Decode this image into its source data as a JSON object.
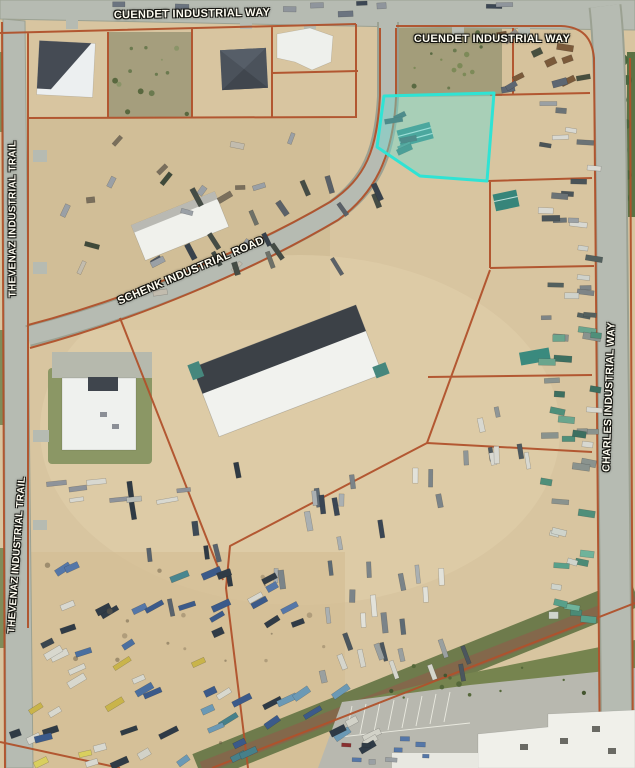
{
  "map": {
    "type": "aerial-parcel-map",
    "road_labels": [
      {
        "id": "cuendet-left",
        "text": "CUENDET INDUSTRIAL WAY"
      },
      {
        "id": "cuendet-right",
        "text": "CUENDET INDUSTRIAL WAY"
      },
      {
        "id": "thevenaz-upper",
        "text": "THEVENAZ INDUSTRIAL TRAIL"
      },
      {
        "id": "schenk",
        "text": "SCHENK INDUSTRIAL ROAD"
      },
      {
        "id": "thevenaz-lower",
        "text": "THEVENAZ INDUSTRIAL TRAIL"
      },
      {
        "id": "charles",
        "text": "CHARLES INDUSTRIAL WAY"
      }
    ],
    "highlight": {
      "label": "selected-parcel",
      "stroke": "#2fe3d4",
      "fill": "rgba(110,220,210,0.45)"
    },
    "colors": {
      "sand": "#d8c5a0",
      "road": "#b6bbb2",
      "parcel_line": "#b0512b",
      "scrub": "#a39d7a",
      "grass": "#76844f",
      "building_white": "#f0f1ec",
      "building_dark_roof": "#3e444c",
      "parking": "#b8b8af"
    },
    "features": {
      "clusters": [
        {
          "id": "top-road-vehicles",
          "x": 60,
          "y": 2,
          "w": 470,
          "h": 12,
          "n": 9,
          "ang": 0,
          "jit": 8,
          "len": 13,
          "wd": 5,
          "colors": [
            "#3c4754",
            "#6b7480",
            "#8f959c"
          ]
        },
        {
          "id": "topright-yard",
          "x": 500,
          "y": 32,
          "w": 85,
          "h": 58,
          "n": 13,
          "ang": -20,
          "jit": 60,
          "len": 13,
          "wd": 6,
          "colors": [
            "#5d6672",
            "#97918a",
            "#caa84b",
            "#7b5a3a",
            "#474f3f"
          ]
        },
        {
          "id": "topleft-yard",
          "x": 52,
          "y": 128,
          "w": 248,
          "h": 165,
          "n": 20,
          "ang": -25,
          "jit": 90,
          "len": 12,
          "wd": 5,
          "colors": [
            "#4e5661",
            "#9aa0a6",
            "#7a6f5c",
            "#3f4a3a",
            "#c2bcae"
          ]
        },
        {
          "id": "schenk-roadside",
          "x": 180,
          "y": 182,
          "w": 200,
          "h": 100,
          "n": 16,
          "ang": 65,
          "jit": 25,
          "len": 15,
          "wd": 5,
          "colors": [
            "#444c45",
            "#5a6168",
            "#38424c",
            "#6e7168"
          ]
        },
        {
          "id": "selected-parcel-trucks",
          "x": 388,
          "y": 112,
          "w": 48,
          "h": 42,
          "n": 5,
          "ang": -18,
          "jit": 20,
          "len": 14,
          "wd": 6,
          "colors": [
            "#2e6e66",
            "#45887e",
            "#334b50"
          ]
        },
        {
          "id": "right-strip-upper",
          "x": 543,
          "y": 100,
          "w": 52,
          "h": 125,
          "n": 15,
          "ang": 4,
          "jit": 14,
          "len": 14,
          "wd": 5,
          "colors": [
            "#d9d9d2",
            "#9aa0a4",
            "#6b7376",
            "#4a5458"
          ]
        },
        {
          "id": "right-strip-mid",
          "x": 545,
          "y": 235,
          "w": 50,
          "h": 85,
          "n": 10,
          "ang": 4,
          "jit": 14,
          "len": 14,
          "wd": 5,
          "colors": [
            "#cfd2cb",
            "#7e8587",
            "#53605e"
          ]
        },
        {
          "id": "right-strip-teal",
          "x": 546,
          "y": 325,
          "w": 52,
          "h": 195,
          "n": 24,
          "ang": 5,
          "jit": 16,
          "len": 14,
          "wd": 6,
          "colors": [
            "#4f8f7a",
            "#6aa58d",
            "#d8d8d0",
            "#3c6f60",
            "#8a938e"
          ]
        },
        {
          "id": "right-bottom-teal",
          "x": 550,
          "y": 528,
          "w": 50,
          "h": 92,
          "n": 12,
          "ang": 8,
          "jit": 18,
          "len": 13,
          "wd": 6,
          "colors": [
            "#58a08a",
            "#6fb39a",
            "#4b8a76",
            "#cfd4cc"
          ]
        },
        {
          "id": "center-rows",
          "x": 255,
          "y": 475,
          "w": 190,
          "h": 160,
          "n": 26,
          "ang": 85,
          "jit": 14,
          "len": 17,
          "wd": 5,
          "colors": [
            "#e2e2da",
            "#aab0b2",
            "#5d6a74",
            "#3a4654",
            "#7b8489"
          ]
        },
        {
          "id": "center-row-left",
          "x": 130,
          "y": 470,
          "w": 110,
          "h": 150,
          "n": 9,
          "ang": 80,
          "jit": 10,
          "len": 16,
          "wd": 5,
          "colors": [
            "#3e4a56",
            "#59636d",
            "#2f3a44"
          ]
        },
        {
          "id": "left-long-row",
          "x": 45,
          "y": 478,
          "w": 145,
          "h": 26,
          "n": 8,
          "ang": -8,
          "jit": 6,
          "len": 17,
          "wd": 5,
          "colors": [
            "#b9bcb6",
            "#8e939a",
            "#d8d8d0"
          ]
        },
        {
          "id": "bottomleft-row1",
          "x": 45,
          "y": 565,
          "w": 255,
          "h": 68,
          "n": 22,
          "ang": -25,
          "jit": 16,
          "len": 16,
          "wd": 6,
          "colors": [
            "#3b5a8a",
            "#5577a8",
            "#d8d8d0",
            "#49868f",
            "#303b46"
          ]
        },
        {
          "id": "bottomleft-row2",
          "x": 35,
          "y": 640,
          "w": 195,
          "h": 75,
          "n": 15,
          "ang": -25,
          "jit": 16,
          "len": 15,
          "wd": 6,
          "colors": [
            "#d8d8ce",
            "#c9b44a",
            "#4a6fa0",
            "#3a464f"
          ]
        },
        {
          "id": "bottomleft-row3",
          "x": 125,
          "y": 688,
          "w": 255,
          "h": 75,
          "n": 24,
          "ang": -30,
          "jit": 14,
          "len": 16,
          "wd": 6,
          "colors": [
            "#3b5a8a",
            "#46808a",
            "#d2d2c8",
            "#2e3a46",
            "#6b99b5"
          ]
        },
        {
          "id": "bottomleft-row4",
          "x": 12,
          "y": 728,
          "w": 118,
          "h": 36,
          "n": 10,
          "ang": -20,
          "jit": 16,
          "len": 14,
          "wd": 6,
          "colors": [
            "#d9cf5e",
            "#d8d8d0",
            "#3b5a8a",
            "#2f3b45"
          ]
        },
        {
          "id": "mid-bottom-row",
          "x": 300,
          "y": 636,
          "w": 175,
          "h": 55,
          "n": 12,
          "ang": 75,
          "jit": 14,
          "len": 15,
          "wd": 5,
          "colors": [
            "#9aa0a0",
            "#d5d5cc",
            "#4b565e",
            "#707a7e"
          ]
        },
        {
          "id": "mid-right-scatter",
          "x": 465,
          "y": 412,
          "w": 75,
          "h": 55,
          "n": 8,
          "ang": 85,
          "jit": 16,
          "len": 14,
          "wd": 5,
          "colors": [
            "#d8d8d0",
            "#8f9697",
            "#4e5a60"
          ]
        },
        {
          "id": "parking-cars",
          "x": 338,
          "y": 736,
          "w": 115,
          "h": 28,
          "n": 9,
          "ang": 3,
          "jit": 8,
          "len": 9,
          "wd": 4.5,
          "colors": [
            "#2f3b45",
            "#d8d8d2",
            "#5577a8",
            "#8a2f2f",
            "#9aa0a4"
          ]
        },
        {
          "id": "scrub-dots-west",
          "shape": "dot",
          "x": 112,
          "y": 36,
          "w": 78,
          "h": 78,
          "n": 14,
          "colors": [
            "#6b7a4f",
            "#59683f",
            "#8a9468"
          ]
        },
        {
          "id": "scrub-dots-north",
          "shape": "dot",
          "x": 395,
          "y": 32,
          "w": 105,
          "h": 60,
          "n": 16,
          "colors": [
            "#6b7a4f",
            "#5a6a42",
            "#7d8a58"
          ]
        },
        {
          "id": "grass-tree-dots",
          "shape": "dot",
          "x": 360,
          "y": 648,
          "w": 250,
          "h": 52,
          "n": 12,
          "colors": [
            "#44552f",
            "#55683a"
          ]
        },
        {
          "id": "yard-texture-dots",
          "shape": "dot",
          "x": 40,
          "y": 560,
          "w": 300,
          "h": 195,
          "n": 18,
          "colors": [
            "rgba(90,80,60,0.45)",
            "rgba(120,105,80,0.4)"
          ]
        }
      ]
    }
  }
}
